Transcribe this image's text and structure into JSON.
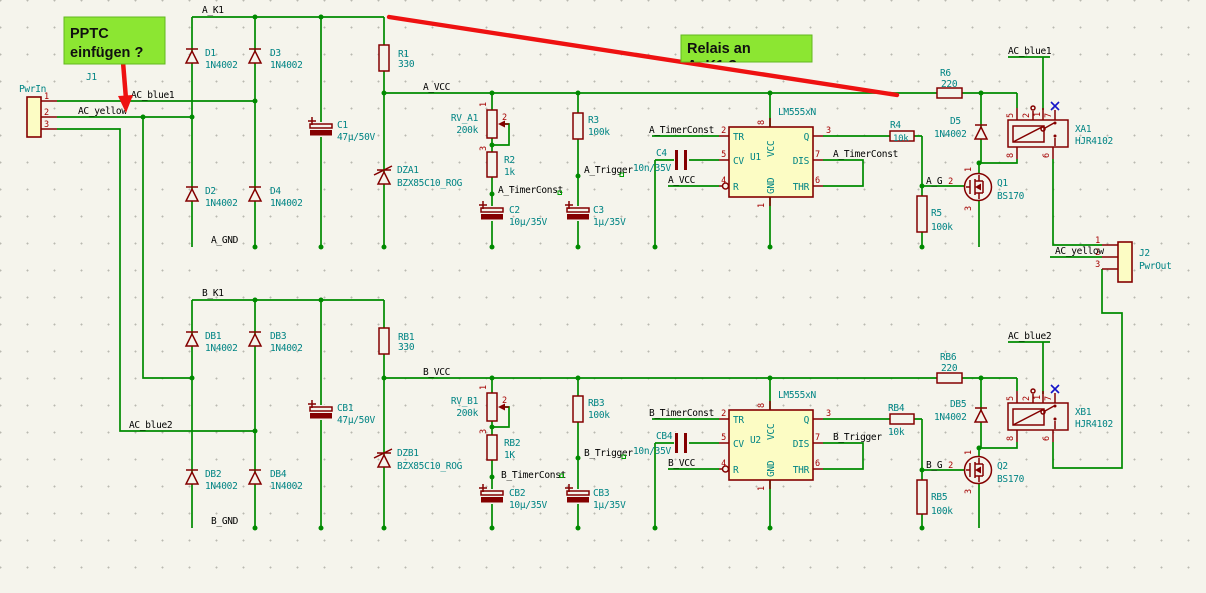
{
  "notes": {
    "pptc": {
      "line1": "PPTC",
      "line2": "einfügen ?"
    },
    "relais": {
      "line1": "Relais an",
      "line2": "A_K1 ?"
    }
  },
  "nets": {
    "a_k1": "A_K1",
    "a_vcc": "A_VCC",
    "a_gnd": "A_GND",
    "a_timerconst": "A_TimerConst",
    "a_trigger": "A_Trigger",
    "a_g": "A_G",
    "b_k1": "B_K1",
    "b_vcc": "B_VCC",
    "b_gnd": "B_GND",
    "b_timerconst": "B_TimerConst",
    "b_trigger": "B_Trigger",
    "b_g": "B_G",
    "ac_blue1": "AC_blue1",
    "ac_blue2": "AC_blue2",
    "ac_yellow": "AC_yellow"
  },
  "pins": {
    "n1": "1",
    "n2": "2",
    "n3": "3",
    "n4": "4",
    "n5": "5",
    "n6": "6",
    "n7": "7",
    "n8": "8"
  },
  "timer": {
    "tr": "TR",
    "cv": "CV",
    "r": "R",
    "q": "Q",
    "dis": "DIS",
    "thr": "THR",
    "vcc": "VCC",
    "gnd": "GND"
  },
  "a": {
    "j1": {
      "ref": "J1",
      "value": "PwrIn"
    },
    "d1": {
      "ref": "D1",
      "value": "1N4002"
    },
    "d2": {
      "ref": "D2",
      "value": "1N4002"
    },
    "d3": {
      "ref": "D3",
      "value": "1N4002"
    },
    "d4": {
      "ref": "D4",
      "value": "1N4002"
    },
    "d5": {
      "ref": "D5",
      "value": "1N4002"
    },
    "c1": {
      "ref": "C1",
      "value": "47µ/50V"
    },
    "c2": {
      "ref": "C2",
      "value": "10µ/35V"
    },
    "c3": {
      "ref": "C3",
      "value": "1µ/35V"
    },
    "c4": {
      "ref": "C4",
      "value": "10n/35V"
    },
    "r1": {
      "ref": "R1",
      "value": "330"
    },
    "r2": {
      "ref": "R2",
      "value": "1k"
    },
    "r3": {
      "ref": "R3",
      "value": "100k"
    },
    "r4": {
      "ref": "R4",
      "value": "10k"
    },
    "r5": {
      "ref": "R5",
      "value": "100k"
    },
    "r6": {
      "ref": "R6",
      "value": "220"
    },
    "rv": {
      "ref": "RV_A1",
      "value": "200k"
    },
    "dz": {
      "ref": "DZA1",
      "value": "BZX85C10_ROG"
    },
    "u": {
      "ref": "U1",
      "value": "LM555xN"
    },
    "q": {
      "ref": "Q1",
      "value": "BS170"
    },
    "x": {
      "ref": "XA1",
      "value": "HJR4102"
    }
  },
  "b": {
    "j2": {
      "ref": "J2",
      "value": "PwrOut"
    },
    "d1": {
      "ref": "DB1",
      "value": "1N4002"
    },
    "d2": {
      "ref": "DB2",
      "value": "1N4002"
    },
    "d3": {
      "ref": "DB3",
      "value": "1N4002"
    },
    "d4": {
      "ref": "DB4",
      "value": "1N4002"
    },
    "d5": {
      "ref": "DB5",
      "value": "1N4002"
    },
    "c1": {
      "ref": "CB1",
      "value": "47µ/50V"
    },
    "c2": {
      "ref": "CB2",
      "value": "10µ/35V"
    },
    "c3": {
      "ref": "CB3",
      "value": "1µ/35V"
    },
    "c4": {
      "ref": "CB4",
      "value": "10n/35V"
    },
    "r1": {
      "ref": "RB1",
      "value": "330"
    },
    "r2": {
      "ref": "RB2",
      "value": "1K"
    },
    "r3": {
      "ref": "RB3",
      "value": "100k"
    },
    "r4": {
      "ref": "RB4",
      "value": "10k"
    },
    "r5": {
      "ref": "RB5",
      "value": "100k"
    },
    "r6": {
      "ref": "RB6",
      "value": "220"
    },
    "rv": {
      "ref": "RV_B1",
      "value": "200k"
    },
    "dz": {
      "ref": "DZB1",
      "value": "BZX85C10_ROG"
    },
    "u": {
      "ref": "U2",
      "value": "LM555xN"
    },
    "q": {
      "ref": "Q2",
      "value": "BS170"
    },
    "x": {
      "ref": "XB1",
      "value": "HJR4102"
    }
  },
  "colors": {
    "wire": "#008a00",
    "symbol": "#840000",
    "field": "#008484",
    "net_label": "#000000",
    "pin_number": "#a40000",
    "ic_fill": "#fcfcc4",
    "note_bg": "#8ce632",
    "annotation": "#ee1111",
    "background": "#f5f4ec",
    "no_connect": "#1414c8"
  }
}
